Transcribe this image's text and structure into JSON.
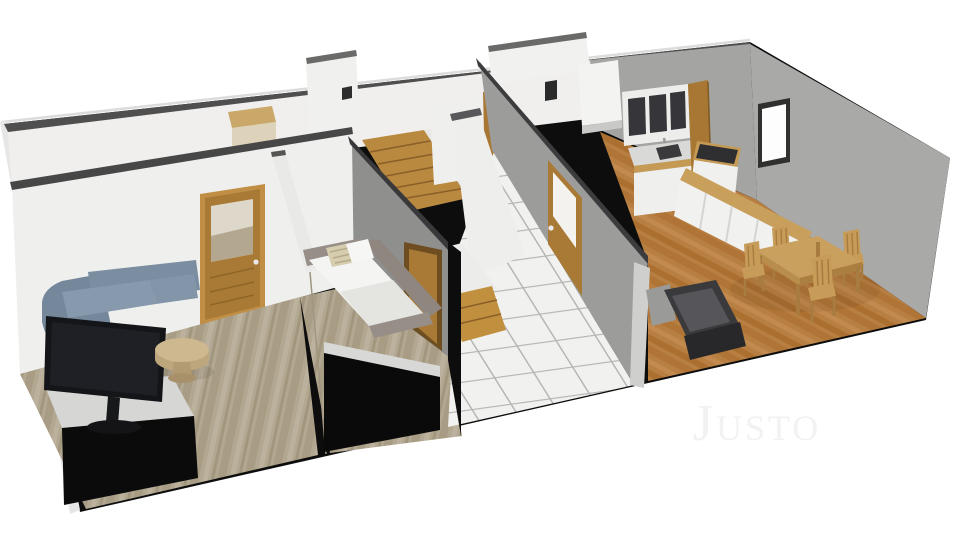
{
  "watermark": {
    "text": "Justo",
    "color": "#f2f2f2"
  },
  "scene": {
    "description": "3D dollhouse-view floor plan render of a single storey, viewed from above at an angle, on a plain white background",
    "background": "#ffffff",
    "rooms": [
      {
        "name": "living-room",
        "walls": "white",
        "floor": "cool taupe wood planks",
        "furniture": [
          "blue-gray corner sofa",
          "black TV on black media cabinet with light top",
          "round wooden coffee table",
          "wooden glazed door in back wall"
        ]
      },
      {
        "name": "bedroom",
        "walls": "white / gray divider",
        "floor": "cool taupe wood planks",
        "furniture": [
          "gray daybed with white mattress",
          "white pillow",
          "striped beige pillow",
          "black low cabinet",
          "doorway with wooden door to hallway"
        ]
      },
      {
        "name": "hallway",
        "walls": "white and gray",
        "floor": "white diamond tiles with gray grout",
        "furniture": [
          "wooden staircase upper flight",
          "wooden staircase bottom steps",
          "wooden glazed door to kitchen",
          "wooden door to back rooms"
        ]
      },
      {
        "name": "kitchen",
        "walls": "gray",
        "floor": "warm oak wood",
        "furniture": [
          "white upper cabinets with dark glass fronts",
          "sink counter with faucet",
          "stove with dark cooktop",
          "white cabinet row with wood countertop",
          "tall white fridge cabinet",
          "wooden back door",
          "window in side wall"
        ]
      },
      {
        "name": "dining-area",
        "walls": "gray",
        "floor": "warm oak wood",
        "furniture": [
          "wooden dining table",
          "four wooden chairs",
          "dark charcoal sofa with light gray end"
        ]
      }
    ],
    "palette": {
      "outer_wall_cut": "#0d0d0d",
      "wall_top_band": "#4f4f4f",
      "white_wall": "#f0efed",
      "gray_wall_light": "#9c9c9a",
      "gray_wall_dark": "#8f8f8d",
      "wood_floor_cool": "#b2a791",
      "wood_floor_warm": "#b87f42",
      "tile_white": "#f1f1ef",
      "tile_grout": "#b4b4b2",
      "door_wood": "#a97a36",
      "stair_wood": "#b9893f",
      "sofa_blue": "#7b8da0",
      "furniture_wood": "#c79c58",
      "dark_sofa": "#3a3a3c"
    }
  }
}
